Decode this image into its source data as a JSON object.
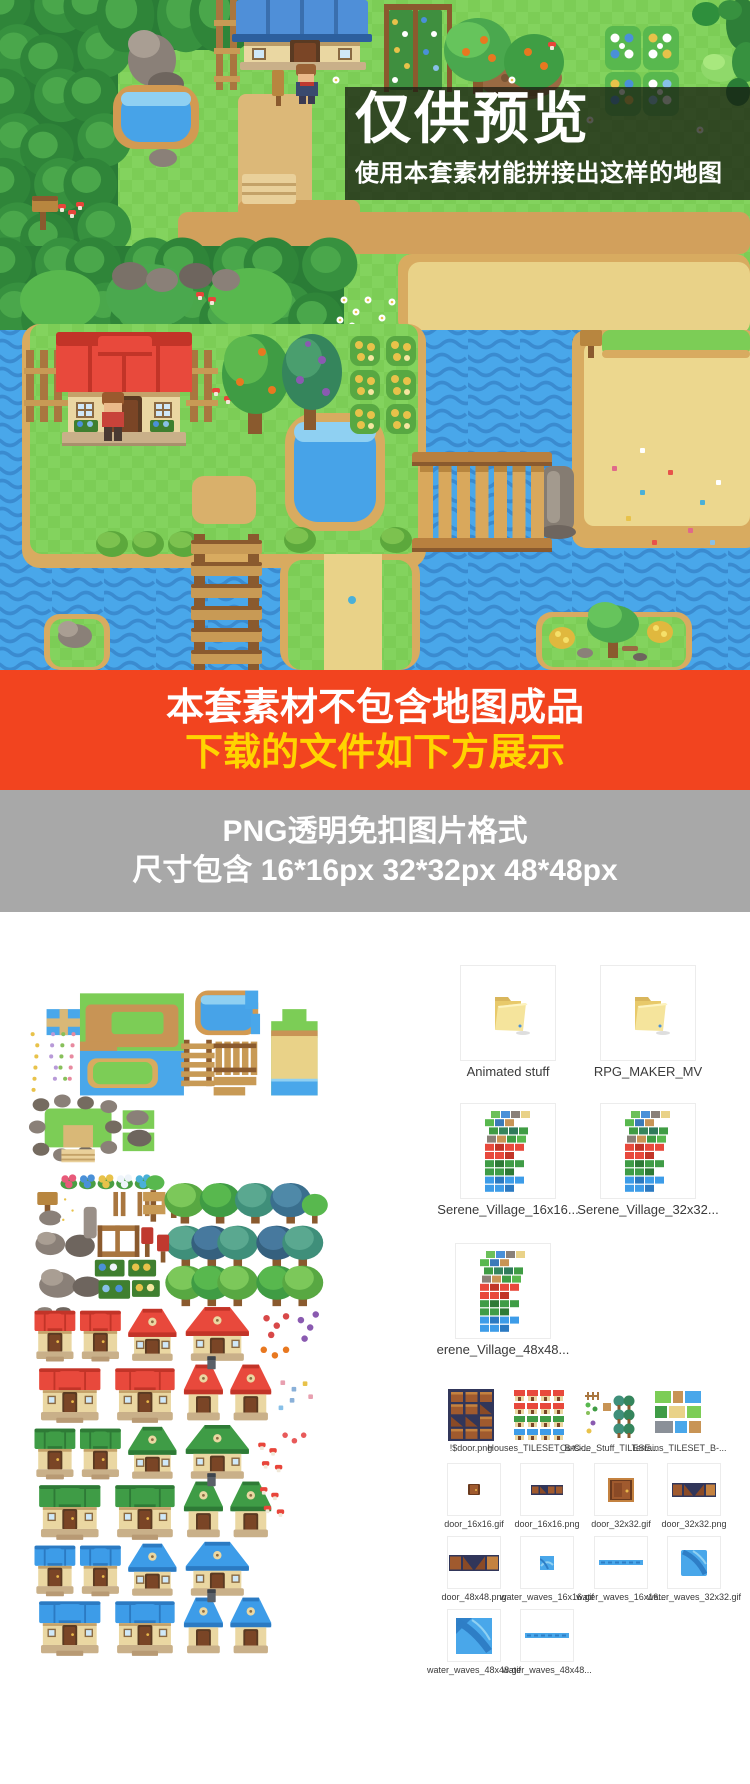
{
  "map": {
    "watermark_title": "仅供预览",
    "watermark_subtitle": "使用本套素材能拼接出这样的地图"
  },
  "banner": {
    "line1": "本套素材不包含地图成品",
    "line2": "下载的文件如下方展示",
    "bg_color": "#f2441f",
    "line1_color": "#ffffff",
    "line2_color": "#ffd400"
  },
  "format_info": {
    "line1": "PNG透明免扣图片格式",
    "line2": "尺寸包含 16*16px  32*32px  48*48px",
    "bg_color": "#a8a8a8",
    "text_color": "#ffffff"
  },
  "files": {
    "rows": [
      {
        "items": [
          {
            "label": "Animated stuff",
            "thumb": "folder-icon"
          },
          {
            "label": "RPG_MAKER_MV",
            "thumb": "folder-icon"
          }
        ]
      },
      {
        "items": [
          {
            "label": "Serene_Village_16x16...",
            "thumb": "tileset-thumb"
          },
          {
            "label": "Serene_Village_32x32...",
            "thumb": "tileset-thumb"
          }
        ]
      },
      {
        "items": [
          {
            "label": "erene_Village_48x48...",
            "thumb": "tileset-thumb"
          }
        ]
      },
      {
        "items": [
          {
            "label": "!$door.png",
            "thumb": "doors-sheet-thumb"
          },
          {
            "label": "Houses_TILESET_B-C-...",
            "thumb": "houses-sheet-thumb"
          },
          {
            "label": "Outside_Stuff_TILESE...",
            "thumb": "outside-sheet-thumb"
          },
          {
            "label": "Terrains_TILESET_B-...",
            "thumb": "terrain-sheet-thumb"
          }
        ]
      },
      {
        "items": [
          {
            "label": "door_16x16.gif",
            "thumb": "door-small-thumb"
          },
          {
            "label": "door_16x16.png",
            "thumb": "door-row-sm-thumb"
          },
          {
            "label": "door_32x32.gif",
            "thumb": "door-mid-thumb"
          },
          {
            "label": "door_32x32.png",
            "thumb": "door-row-md-thumb"
          }
        ]
      },
      {
        "items": [
          {
            "label": "door_48x48.png",
            "thumb": "door-row-lg-thumb"
          },
          {
            "label": "water_waves_16x16.gif",
            "thumb": "water-sq-sm-thumb"
          },
          {
            "label": "water_waves_16x16...",
            "thumb": "water-line-thumb"
          },
          {
            "label": "water_waves_32x32.gif",
            "thumb": "water-sq-md-thumb"
          }
        ]
      },
      {
        "items": [
          {
            "label": "water_waves_48x48.gif",
            "thumb": "water-sq-lg-thumb"
          },
          {
            "label": "water_waves_48x48...",
            "thumb": "water-line-thumb"
          }
        ]
      }
    ]
  },
  "palette": {
    "grass": "#7ccd56",
    "water": "#49a7ea",
    "sand": "#e9d288",
    "roof_red": "#e8493c",
    "roof_green": "#3f9c46",
    "roof_blue": "#3d9ce8"
  }
}
